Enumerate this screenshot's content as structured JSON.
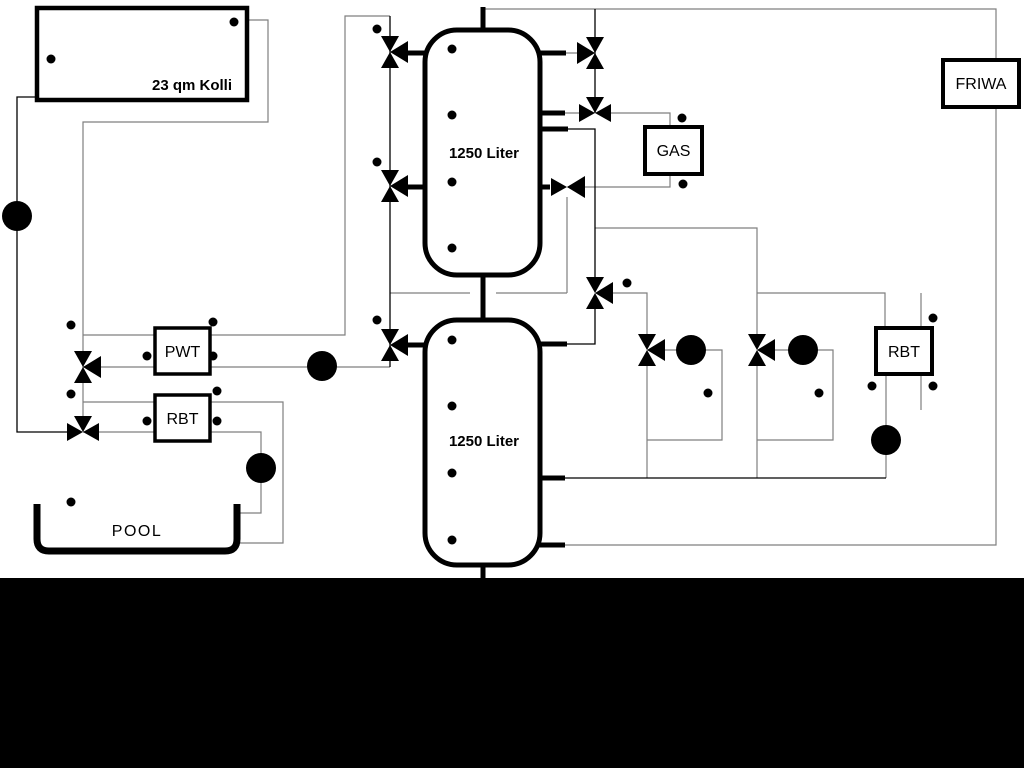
{
  "diagram": {
    "title_hint": "hydraulic heating scheme with solar collector, buffer tanks, gas boiler, fresh water station and pool",
    "colors": {
      "background": "#ffffff",
      "bottom_bar": "#000000",
      "pipe_gray": "#7f7f7f",
      "pipe_black": "#000000"
    },
    "components": {
      "collector": {
        "label": "23 qm Kolli"
      },
      "buffer_tank_top": {
        "label": "1250 Liter"
      },
      "buffer_tank_bottom": {
        "label": "1250 Liter"
      },
      "pwt": {
        "label": "PWT"
      },
      "rbt_pool": {
        "label": "RBT"
      },
      "gas_boiler": {
        "label": "GAS"
      },
      "friwa": {
        "label": "FRIWA"
      },
      "rbt_heating": {
        "label": "RBT"
      },
      "pool": {
        "label": "POOL"
      }
    }
  }
}
